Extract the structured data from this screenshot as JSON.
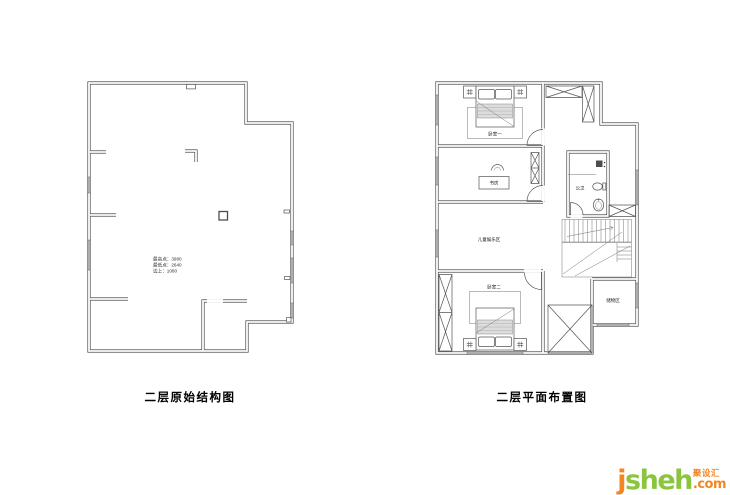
{
  "left_plan": {
    "caption": "二层原始结构图",
    "annotation": {
      "line1": "最高点：3980",
      "line2": "最低点：2640",
      "line3": "边上：1080"
    }
  },
  "right_plan": {
    "caption": "二层平面布置图",
    "labels": {
      "bedroom1": "卧室一",
      "study": "书房",
      "kids_area": "儿童娱乐区",
      "bathroom": "公卫",
      "storage": "储物区",
      "bedroom2": "卧室二"
    }
  },
  "watermark": {
    "brand": "jsheh",
    "domain_suffix": ".com",
    "chinese": "聚设汇",
    "orange": "#f5861f",
    "green": "#8bc53d"
  },
  "drawing_colors": {
    "wall_line": "#4d4d4d",
    "window_fill": "#aeaeae",
    "background": "#ffffff"
  }
}
